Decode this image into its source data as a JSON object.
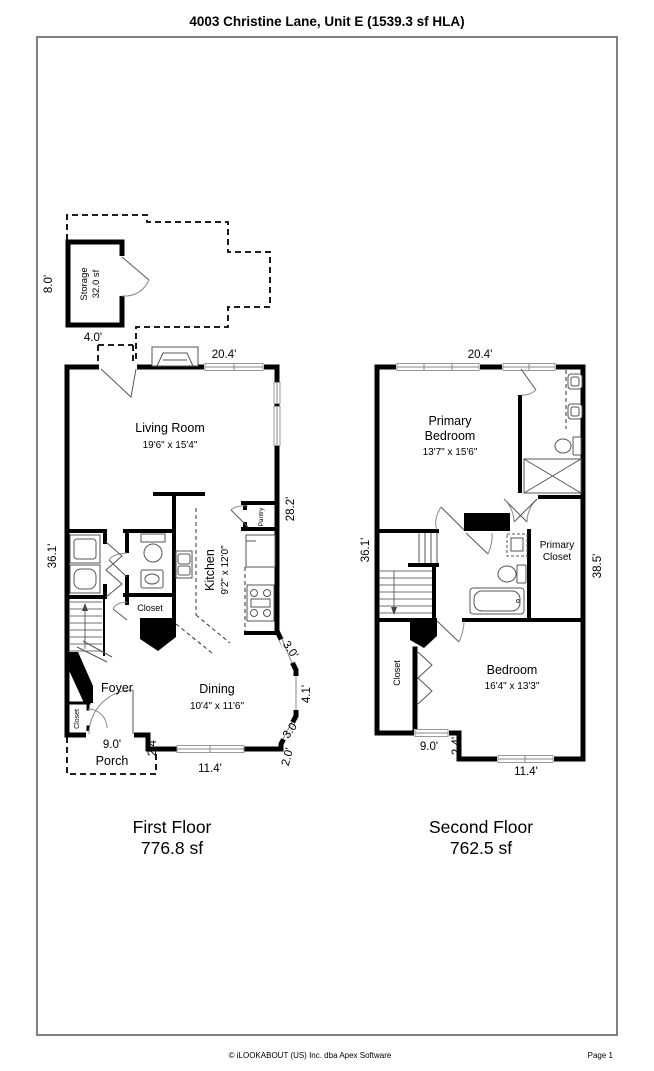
{
  "page": {
    "title": "4003 Christine Lane, Unit E (1539.3 sf HLA)",
    "footer_copyright": "© iLOOKABOUT (US) Inc. dba Apex Software",
    "footer_page": "Page 1"
  },
  "colors": {
    "wall": "#000000",
    "border_gray": "#808080",
    "background": "#ffffff",
    "fixture_gray": "#555555"
  },
  "f1": {
    "floor_label": "First Floor",
    "floor_area": "776.8 sf",
    "living_name": "Living Room",
    "living_dims": "19'6\" x 15'4\"",
    "kitchen_name": "Kitchen",
    "kitchen_dims": "9'2\" x 12'0\"",
    "dining_name": "Dining",
    "dining_dims": "10'4\" x 11'6\"",
    "foyer": "Foyer",
    "porch": "Porch",
    "storage_name": "Storage",
    "storage_area": "32.0 sf",
    "pantry": "Pantry",
    "closet_hall": "Closet",
    "closet_foyer": "Closet",
    "dim_top": "20.4'",
    "dim_right": "28.2'",
    "dim_left": "36.1'",
    "dim_storage_h": "8.0'",
    "dim_storage_w": "4.0'",
    "dim_bay1": "3.0'",
    "dim_bay2": "4.1'",
    "dim_bay3": "3.0'",
    "dim_bay4": "2.0'",
    "dim_step": "2.4'",
    "dim_bottom": "11.4'",
    "dim_porch": "9.0'"
  },
  "f2": {
    "floor_label": "Second Floor",
    "floor_area": "762.5 sf",
    "primary_line1": "Primary",
    "primary_line2": "Bedroom",
    "primary_dims": "13'7\" x 15'6\"",
    "pcloset_line1": "Primary",
    "pcloset_line2": "Closet",
    "bedroom_name": "Bedroom",
    "bedroom_dims": "16'4\" x 13'3\"",
    "closet": "Closet",
    "dim_top": "20.4'",
    "dim_left": "36.1'",
    "dim_right": "38.5'",
    "dim_bottom_left": "9.0'",
    "dim_step": "2.4'",
    "dim_bottom": "11.4'"
  }
}
